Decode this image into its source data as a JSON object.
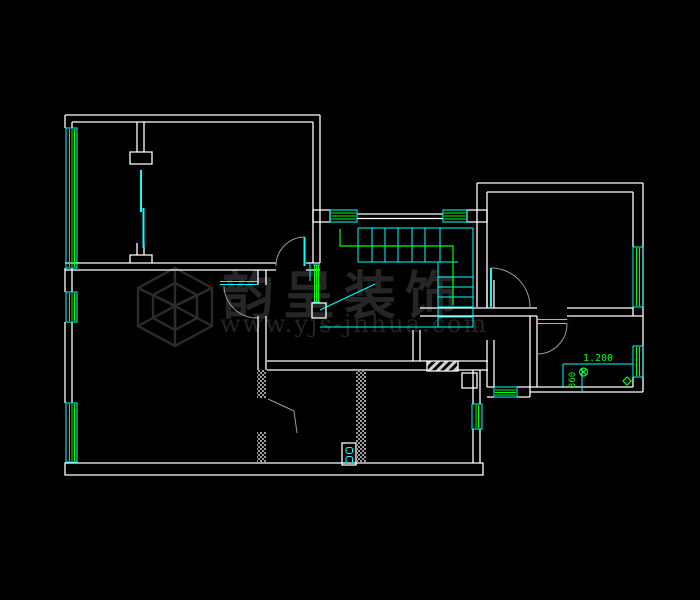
{
  "document": {
    "type": "cad-floor-plan",
    "background": "#000000",
    "canvas_width": 700,
    "canvas_height": 600
  },
  "watermark": {
    "logo": "isometric-cube-logo",
    "brand_text": "韵呈装饰",
    "url_text": "www.yjs-jnhua.com",
    "color": "#262626"
  },
  "dimensions": [
    {
      "label": "1.200",
      "orientation": "horizontal"
    },
    {
      "label": "360",
      "orientation": "vertical"
    }
  ],
  "colors": {
    "wall": "#ffffff",
    "window_frame": "#00ffff",
    "glazing": "#00ff00",
    "stair": "#00ffff",
    "handrail": "#00ff00",
    "door_swing": "#9a9a9a",
    "dimension_line": "#00ffff",
    "dimension_text": "#00ff00",
    "hatch": "#b4b4b4"
  },
  "symbols": [
    {
      "name": "floor-drain",
      "color": "#00ff00"
    },
    {
      "name": "diamond-marker",
      "color": "#00ff00"
    },
    {
      "name": "stove-burners",
      "color": "#00ffff"
    }
  ]
}
